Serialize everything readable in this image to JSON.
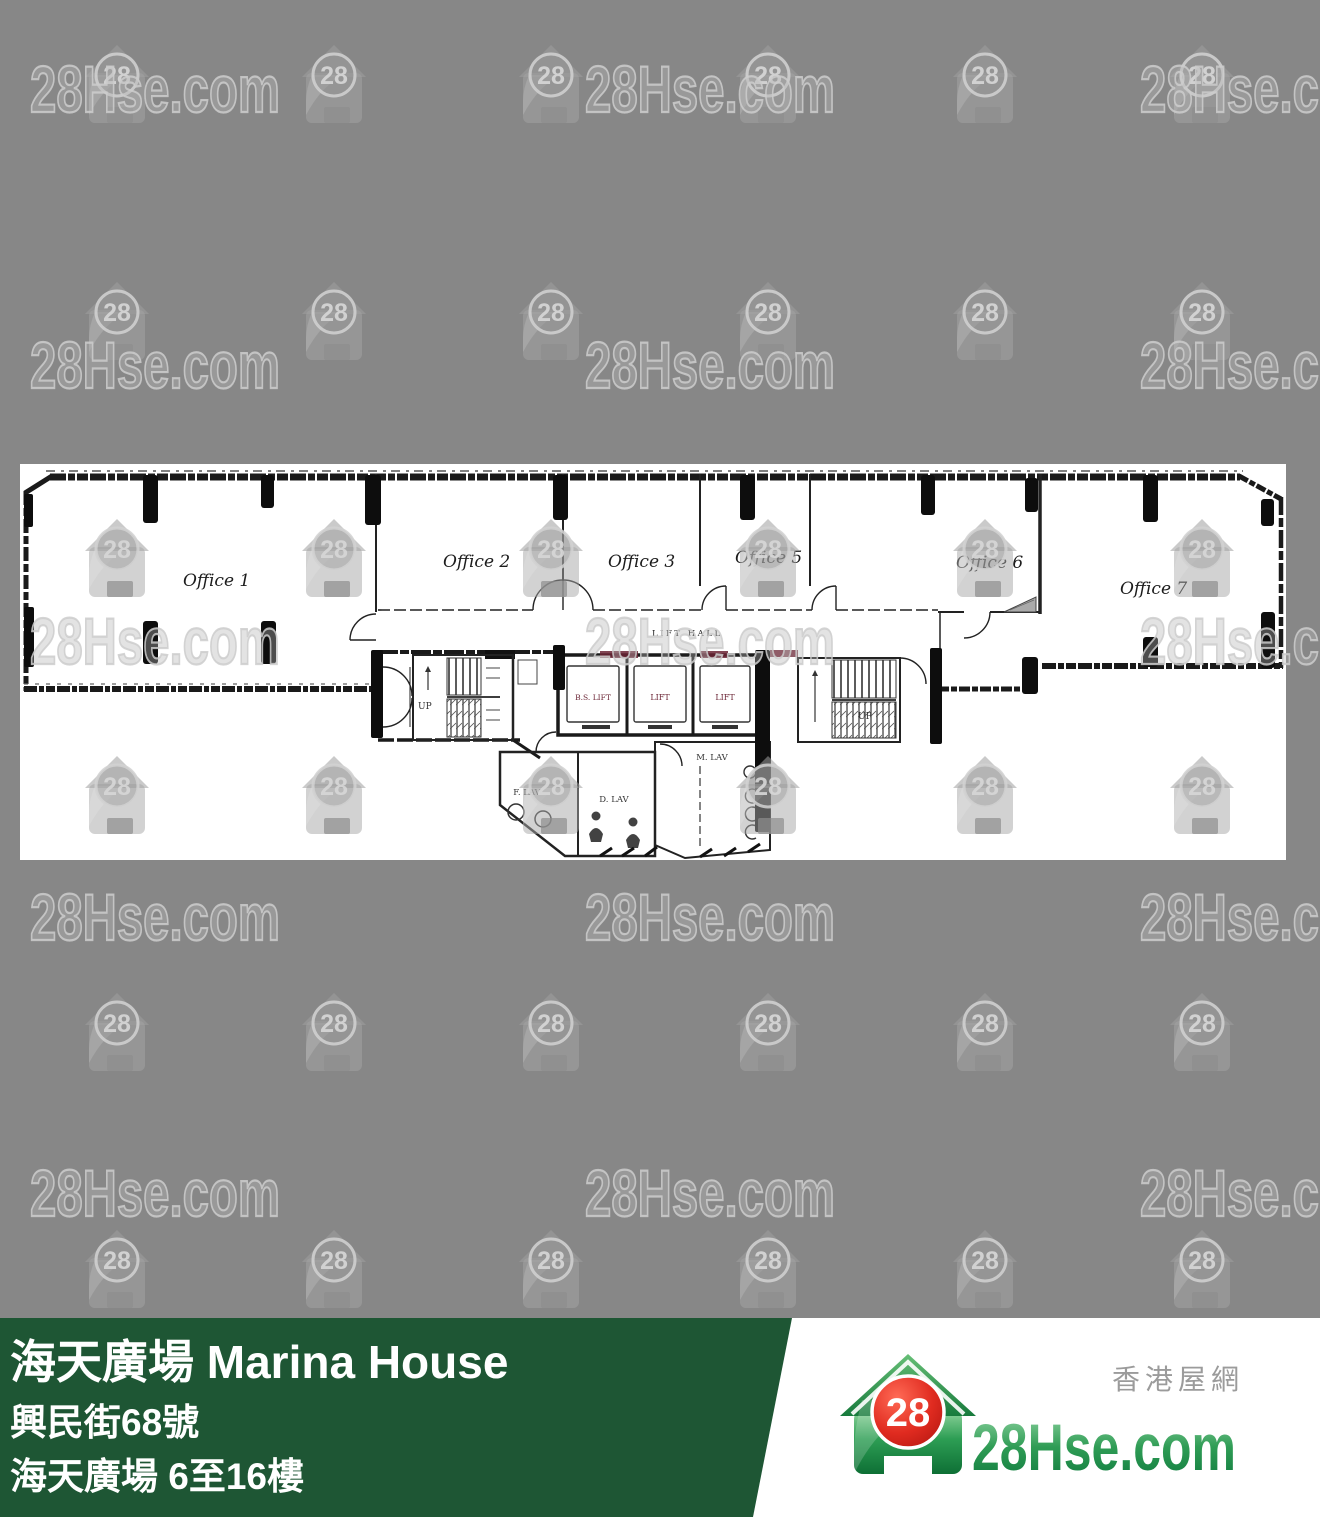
{
  "page": {
    "background": "#878787"
  },
  "watermark": {
    "brand": "28Hse.com",
    "badge": "28"
  },
  "floor_plan": {
    "offices": [
      "Office 1",
      "Office 2",
      "Office 3",
      "Office 5",
      "Office 6",
      "Office 7"
    ],
    "lift_hall_label": "LIFT HALL",
    "lift_labels": [
      "B.S. LIFT",
      "LIFT",
      "LIFT"
    ],
    "stairs_label": "UP",
    "lav_labels": {
      "male": "M. LAV",
      "female": "F. LAV",
      "disabled": "D. LAV"
    }
  },
  "banner": {
    "title": "海天廣場 Marina House",
    "address": "興民街68號",
    "floors": "海天廣場 6至16樓",
    "background": "#1e5634"
  },
  "logo": {
    "badge": "28",
    "brand": "28Hse.com",
    "tagline": "香港屋網",
    "brand_green": "#1e8a4a",
    "badge_red": "#e02b20"
  },
  "colors": {
    "plan_ink": "#1a1a1a",
    "lift_label_maroon": "#6b2535",
    "watermark_gray": "#c9c9c9"
  }
}
